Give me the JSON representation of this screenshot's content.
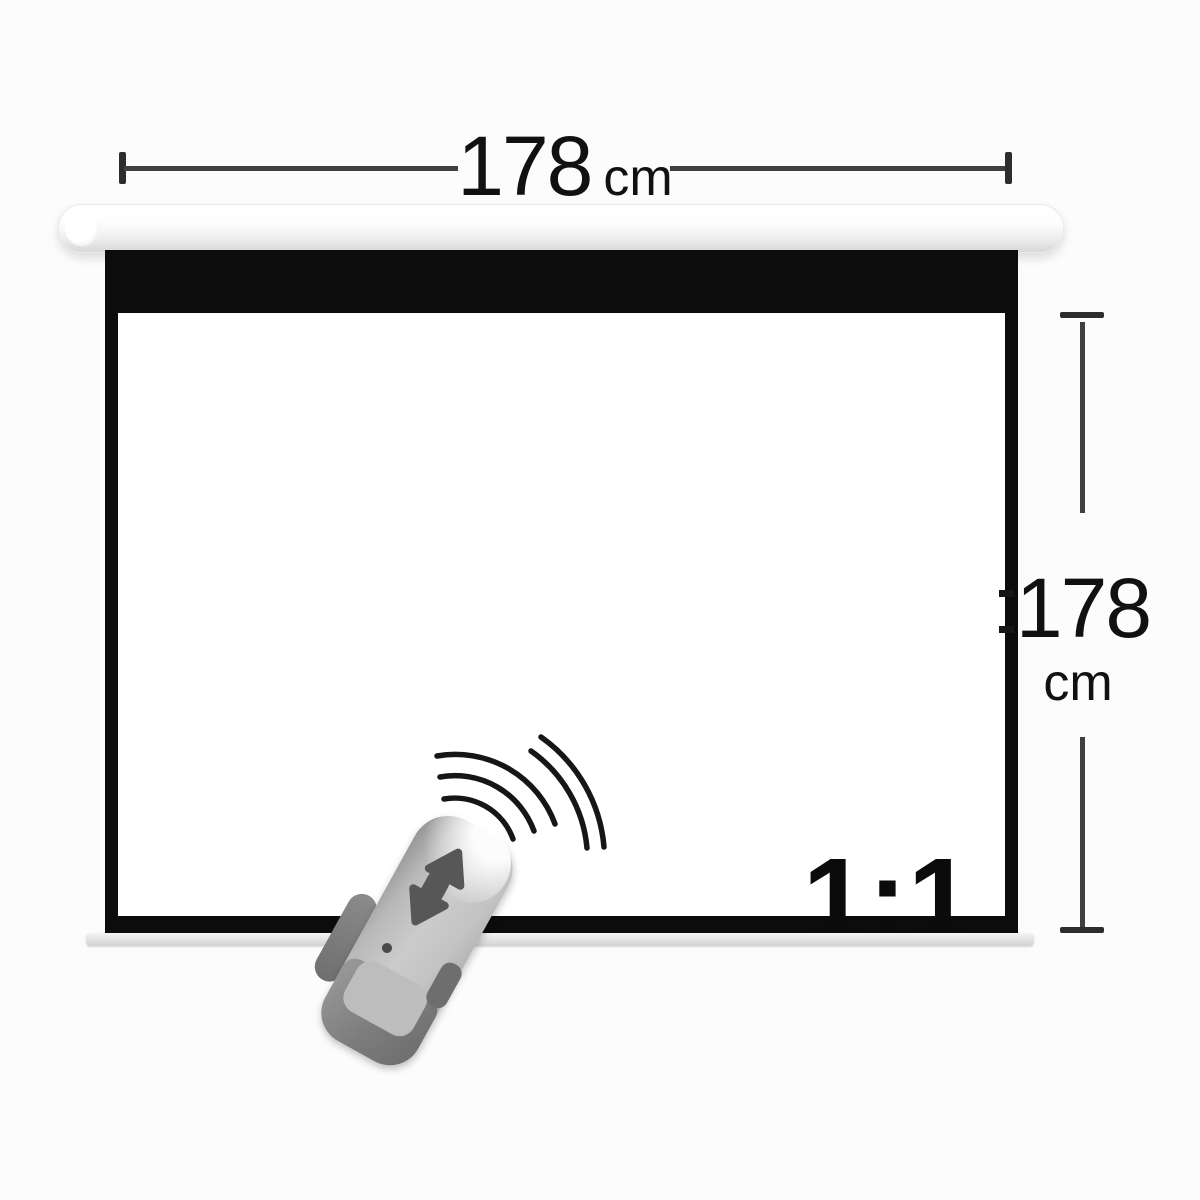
{
  "labels": {
    "width": {
      "value": "178",
      "unit": "cm"
    },
    "height": {
      "value": "178",
      "unit": "cm"
    },
    "aspect_ratio": "1:1"
  },
  "icons": {
    "remote_control": "remote-control",
    "signal_waves": "signal-waves-icon",
    "up_button": "remote-up-button-icon",
    "stop_button": "remote-stop-button-icon",
    "down_button": "remote-down-button-icon",
    "ir_led": "ir-led-icon"
  },
  "colors": {
    "background": "#fcfcfc",
    "screen_frame": "#0c0c0c",
    "screen_surface": "#ffffff",
    "dimension_lines": "#3f3f3f",
    "label_text": "#111111",
    "housing": "#f0f0f0",
    "bottom_slat": "#d8d8d8",
    "remote_body": "#c3c3c3",
    "remote_dark_trim": "#6e6e6e",
    "remote_buttons": "#575757"
  }
}
